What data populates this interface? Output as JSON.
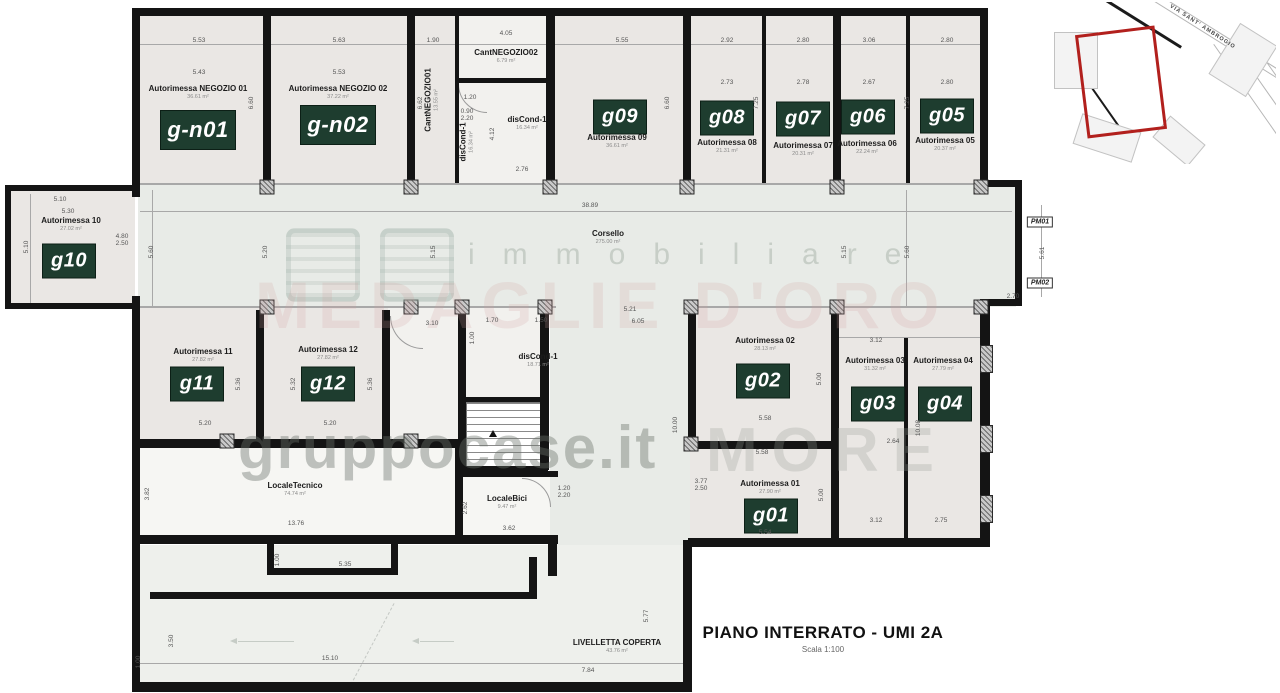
{
  "title": {
    "main": "PIANO INTERRATO - UMI 2A",
    "scale": "Scala 1:100"
  },
  "rooms": [
    {
      "name": "Autorimessa NEGOZIO 01",
      "area": "36.61 m²",
      "badge": "g-n01"
    },
    {
      "name": "Autorimessa NEGOZIO 02",
      "area": "37.22 m²",
      "badge": "g-n02"
    },
    {
      "name": "CantNEGOZIO01",
      "area": "13.55 m²"
    },
    {
      "name": "CantNEGOZIO02",
      "area": "6.79 m²"
    },
    {
      "name": "disCond-1",
      "area": "16.34 m²"
    },
    {
      "name": "Autorimessa 09",
      "area": "36.61 m²",
      "badge": "g09"
    },
    {
      "name": "Autorimessa 08",
      "area": "21.31 m²",
      "badge": "g08"
    },
    {
      "name": "Autorimessa 07",
      "area": "20.31 m²",
      "badge": "g07"
    },
    {
      "name": "Autorimessa 06",
      "area": "22.24 m²",
      "badge": "g06"
    },
    {
      "name": "Autorimessa 05",
      "area": "20.37 m²",
      "badge": "g05"
    },
    {
      "name": "Autorimessa 10",
      "area": "27.02 m²",
      "badge": "g10"
    },
    {
      "name": "Corsello",
      "area": "275.00 m²"
    },
    {
      "name": "Autorimessa 11",
      "area": "27.82 m²",
      "badge": "g11"
    },
    {
      "name": "Autorimessa 12",
      "area": "27.82 m²",
      "badge": "g12"
    },
    {
      "name": "disCond-1",
      "area": "18.71 m²"
    },
    {
      "name": "Autorimessa 02",
      "area": "28.13 m²",
      "badge": "g02"
    },
    {
      "name": "Autorimessa 03",
      "area": "31.32 m²",
      "badge": "g03"
    },
    {
      "name": "Autorimessa 04",
      "area": "27.79 m²",
      "badge": "g04"
    },
    {
      "name": "Autorimessa 01",
      "area": "27.90 m²",
      "badge": "g01"
    },
    {
      "name": "LocaleTecnico",
      "area": "74.74 m²"
    },
    {
      "name": "LocaleBici",
      "area": "9.47 m²"
    },
    {
      "name": "LIVELLETTA COPERTA",
      "area": "43.76 m²"
    }
  ],
  "markers": {
    "pm01": "PM01",
    "pm02": "PM02"
  },
  "inset": {
    "street": "VIA SANT' AMBROGIO"
  },
  "watermark": {
    "line1": "immobiliare",
    "line2": "MEDAGLIE D'ORO",
    "line3": "gruppocase.it",
    "line4": "MORE"
  },
  "colors": {
    "badge_green": "#1e3d2f",
    "wall_black": "#141414",
    "inset_red": "#b2201d"
  },
  "dims": [
    "5.53",
    "5.63",
    "1.90",
    "4.05",
    "5.55",
    "2.92",
    "2.80",
    "3.06",
    "2.80",
    "5.43",
    "5.53",
    "2.73",
    "2.78",
    "2.67",
    "2.80",
    "6.60",
    "6.62",
    "6.60",
    "7.25",
    "7.25",
    "4.12",
    "2.76",
    "1.20",
    "38.89",
    "5.10",
    "5.30",
    "5.10",
    "4.80",
    "2.50",
    "5.60",
    "5.20",
    "5.15",
    "5.15",
    "5.60",
    "5.61",
    "2.70",
    "5.21",
    "6.05",
    "3.10",
    "1.70",
    "1.50",
    "1.00",
    "3.12",
    "5.36",
    "5.32",
    "5.36",
    "5.00",
    "10.00",
    "10.08",
    "5.58",
    "5.20",
    "5.20",
    "2.64",
    "5.58",
    "3.77",
    "2.50",
    "5.00",
    "3.12",
    "2.75",
    "5.54",
    "13.76",
    "3.62",
    "1.20",
    "2.20",
    "2.62",
    "3.82",
    "1.00",
    "5.35",
    "3.50",
    "15.10",
    "7.84",
    "5.77",
    "1.00",
    "0.90",
    "2.20"
  ]
}
